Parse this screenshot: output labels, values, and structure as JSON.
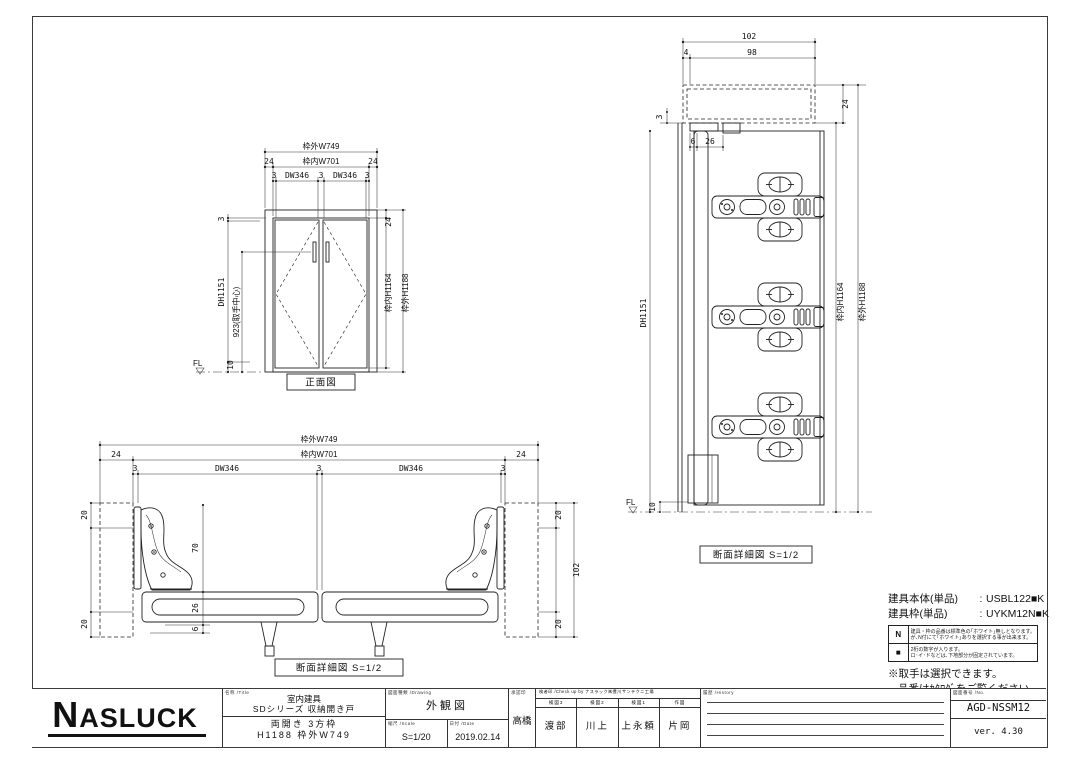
{
  "front_view": {
    "label": "正面図",
    "w_outer": "枠外W749",
    "w24l": "24",
    "w_inner": "枠内W701",
    "w24r": "24",
    "g3a": "3",
    "dw1": "DW346",
    "g3b": "3",
    "dw2": "DW346",
    "g3c": "3",
    "v3": "3",
    "dh": "DH1151",
    "handle": "923(取手中心)",
    "v10": "10",
    "fl": "FL",
    "v24": "24",
    "h_inner": "枠内H1164",
    "h_outer": "枠外H1188"
  },
  "section_side": {
    "label": "断面詳細図 S=1/2",
    "d102": "102",
    "d4": "4",
    "d98": "98",
    "d3": "3",
    "d24": "24",
    "d6": "6",
    "d26": "26",
    "dh": "DH1151",
    "h_inner": "枠内H1164",
    "h_outer": "枠外H1188",
    "fl": "FL",
    "d10": "10"
  },
  "section_plan": {
    "label": "断面詳細図 S=1/2",
    "w_outer": "枠外W749",
    "w24l": "24",
    "w_inner": "枠内W701",
    "w24r": "24",
    "g3a": "3",
    "dw1": "DW346",
    "g3b": "3",
    "dw2": "DW346",
    "g3c": "3",
    "l20t": "20",
    "l20b": "20",
    "c70": "70",
    "c26": "26",
    "c6": "6",
    "r20t": "20",
    "r102": "102",
    "r20b": "20"
  },
  "parts_info": {
    "body_label": "建具本体(単品)",
    "sep": ":",
    "body_value": "USBL122■K",
    "frame_label": "建具枠(単品)",
    "frame_value": "UYKM12N■K",
    "note_n_key": "N",
    "note_n_line1": "建具・枠の品番は標準色の｢ホワイト｣無しとなります。",
    "note_n_line2": "が､N付にて｢ホワイト｣ありを選択する事が出来ます。",
    "note_sq_key": "■",
    "note_sq_line1": "2桁の数字が入ります。",
    "note_sq_line2": "ロ･イ･ドなどは､下地部分が固定されています。",
    "remark1": "※取手は選択できます。",
    "remark2": "品番はｶﾀﾛｸﾞをご覧ください。"
  },
  "title_block": {
    "logo": "NASLUCK",
    "title_header": "名称 /Title",
    "title_line1": "室内建具",
    "title_line2": "SDシリーズ 収納開き戸",
    "title_line3": "両開き 3方枠",
    "title_line4": "H1188 枠外W749",
    "drawing_header": "図面種類 /Drawing",
    "drawing_type": "外観図",
    "scale_header": "縮尺 /Scale",
    "scale": "S=1/20",
    "date_header": "日付 /Date",
    "date": "2019.02.14",
    "approval_header": "承認印",
    "approval_name": "高橋",
    "check_header": "検者印 /Check up by ナスラック㈱豊川サンテクニ工場",
    "check_cols": [
      {
        "header": "検図3",
        "name": "渡部"
      },
      {
        "header": "検図2",
        "name": "川上"
      },
      {
        "header": "検図1",
        "name": "上永頼"
      },
      {
        "header": "作図",
        "name": "片岡"
      }
    ],
    "history_header": "履歴 /History",
    "number_header": "図面番号 /No.",
    "number": "AGD-NSSM12",
    "version": "ver. 4.30"
  }
}
